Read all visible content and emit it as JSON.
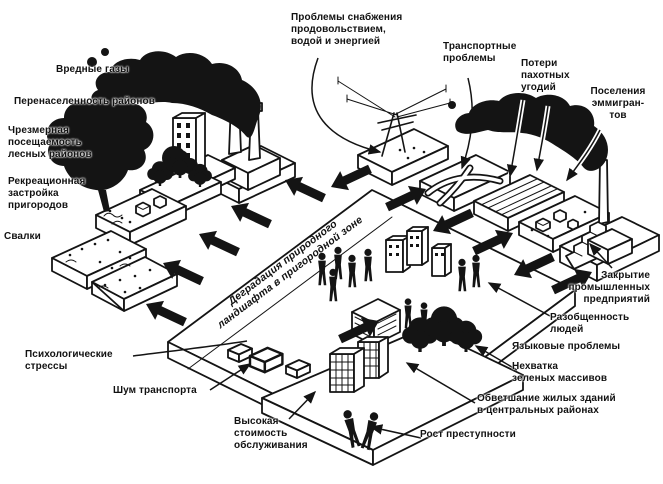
{
  "colors": {
    "ink": "#141414",
    "paper": "#ffffff"
  },
  "center_band": {
    "text": "Деградация природного\nландшафта в пригородной зоне"
  },
  "labels": {
    "vrednye_gazy": "Вредные газы",
    "perenaselennost": "Перенаселенность районов",
    "chrezmernaya": "Чрезмерная\nпосещаемость\nлесных районов",
    "rekreatsionnaya": "Рекреационная\nзастройка\nпригородов",
    "svalki": "Свалки",
    "psikhologicheskie": "Психологические\nстрессы",
    "shum_transporta": "Шум транспорта",
    "vysokaya_stoimost": "Высокая\nстоимость\nобслуживания",
    "problemy_snabzheniya": "Проблемы снабжения\nпродовольствием,\nводой и энергией",
    "transportnye": "Транспортные\nпроблемы",
    "poteri_pakhotnykh": "Потери\nпахотных\nугодий",
    "poseleniya_emmigrantov": "Поселения\nэммигран-\nтов",
    "zakrytie": "Закрытие\nпромышленных\nпредприятий",
    "razobshchennost": "Разобщенность\nлюдей",
    "yazykovye": "Языковые проблемы",
    "nekhvatka": "Нехватка\nзеленых массивов",
    "obvetshanie": "Обветшание жилых зданий\nв центральных районах",
    "rost_prestupnosti": "Рост преступности"
  }
}
